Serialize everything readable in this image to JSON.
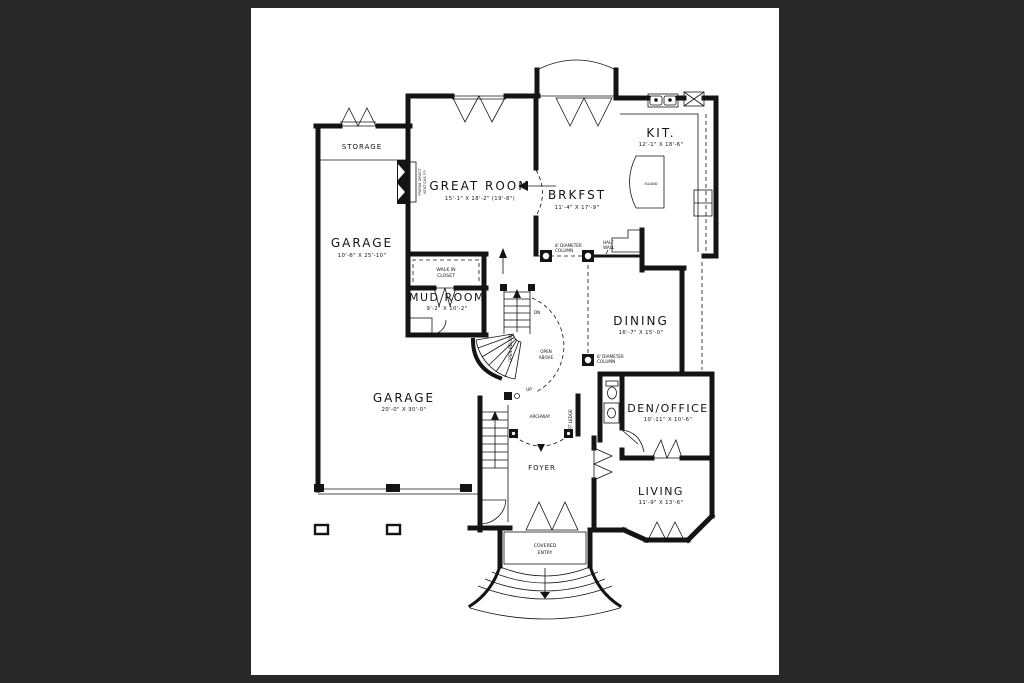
{
  "colors": {
    "background": "#282828",
    "paper": "#ffffff",
    "ink": "#141414"
  },
  "rooms": {
    "storage": {
      "label": "STORAGE"
    },
    "great_room": {
      "label": "GREAT ROOM",
      "dims": "15'-1\" X 18'-2\" (19'-8\")"
    },
    "brkfst": {
      "label": "BRKFST",
      "dims": "11'-4\" X 17'-9\""
    },
    "kitchen": {
      "label": "KIT.",
      "dims": "12'-1\" X 18'-6\""
    },
    "island": {
      "label": "ISLAND"
    },
    "garage_upper": {
      "label": "GARAGE",
      "dims": "10'-6\" X 25'-10\""
    },
    "garage_main": {
      "label": "GARAGE",
      "dims": "20'-0\" X 30'-0\""
    },
    "walk_in_closet": {
      "line1": "WALK IN",
      "line2": "CLOSET"
    },
    "mud_room": {
      "label": "MUD ROOM",
      "dims": "9'-2\" X 10'-2\""
    },
    "dining": {
      "label": "DINING",
      "dims": "16'-7\" X 15'-0\""
    },
    "den_office": {
      "label": "DEN/OFFICE",
      "dims": "10'-11\" X 10'-6\""
    },
    "living": {
      "label": "LIVING",
      "dims": "11'-9\" X 13'-6\""
    },
    "foyer": {
      "label": "FOYER"
    },
    "covered_entry": {
      "line1": "COVERED",
      "line2": "ENTRY"
    }
  },
  "annotations": {
    "column": {
      "line1": "8' DIAMETER",
      "line2": "COLUMN"
    },
    "half_wall": {
      "line1": "HALF",
      "line2": "WALL"
    },
    "archway": "ARCHWAY",
    "art_ledge": "ART LEDGE",
    "open_above": {
      "line1": "OPEN",
      "line2": "ABOVE"
    },
    "open_below": "OPEN BELOW",
    "down": "DN",
    "up": "UP",
    "fireplace": {
      "line1": "PREFAB DIRECT",
      "line2": "VENT GAS F.P."
    }
  }
}
